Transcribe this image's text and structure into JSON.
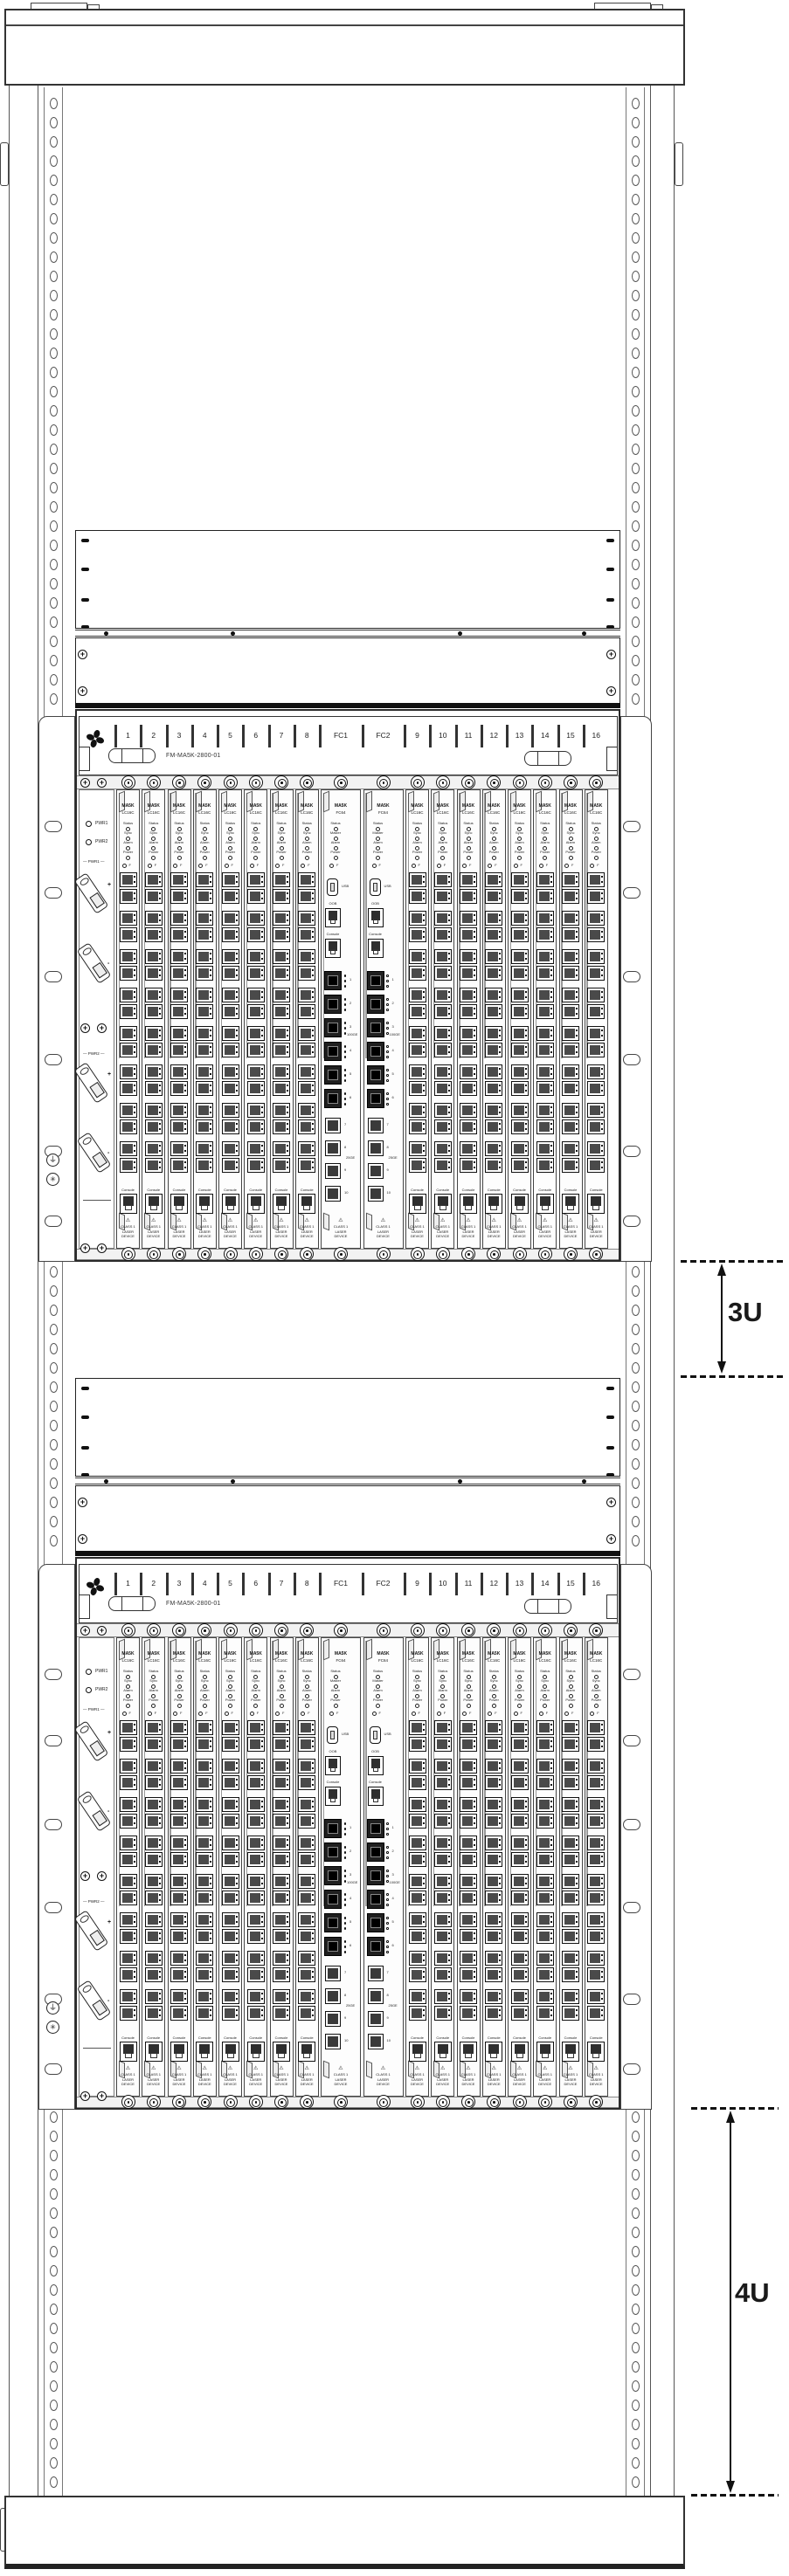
{
  "annotations": {
    "clearance_top": "3U",
    "clearance_bottom": "4U"
  },
  "chassis": {
    "model_label": "FM-MA5K-2800-01",
    "slots": [
      "1",
      "2",
      "3",
      "4",
      "5",
      "6",
      "7",
      "8",
      "FC1",
      "FC2",
      "9",
      "10",
      "11",
      "12",
      "13",
      "14",
      "15",
      "16"
    ],
    "power_panel": {
      "led_labels": [
        "PWR1",
        "PWR2"
      ],
      "breaker_group_labels": [
        "PWR1",
        "PWR2"
      ],
      "polarity_plus": "+",
      "polarity_minus": "-"
    },
    "line_card": {
      "model_line1": "MA5K",
      "model_line2": "LC16C",
      "led_labels": [
        "Status",
        "Sync",
        "Alarm",
        "Power"
      ],
      "button_label": "F",
      "console_label": "Console",
      "laser_warning_lines": [
        "CLASS 1",
        "LASER",
        "DEVICE"
      ]
    },
    "fabric_card": {
      "model_line1": "MA5K",
      "model_line2": "FC64",
      "led_labels": [
        "Status",
        "Master",
        "Alarm",
        "Power"
      ],
      "button_label": "F",
      "usb_label": "USB",
      "oob_label": "OOB",
      "console_label": "Console",
      "qsfp_port_labels": [
        "1",
        "2",
        "3",
        "4",
        "5",
        "6"
      ],
      "qsfp_speed_label": "100GE",
      "sfp_port_labels": [
        "7",
        "8",
        "9",
        "10"
      ],
      "sfp_speed_label": "25GE",
      "laser_warning_lines": [
        "CLASS 1",
        "LASER",
        "DEVICE"
      ]
    }
  }
}
